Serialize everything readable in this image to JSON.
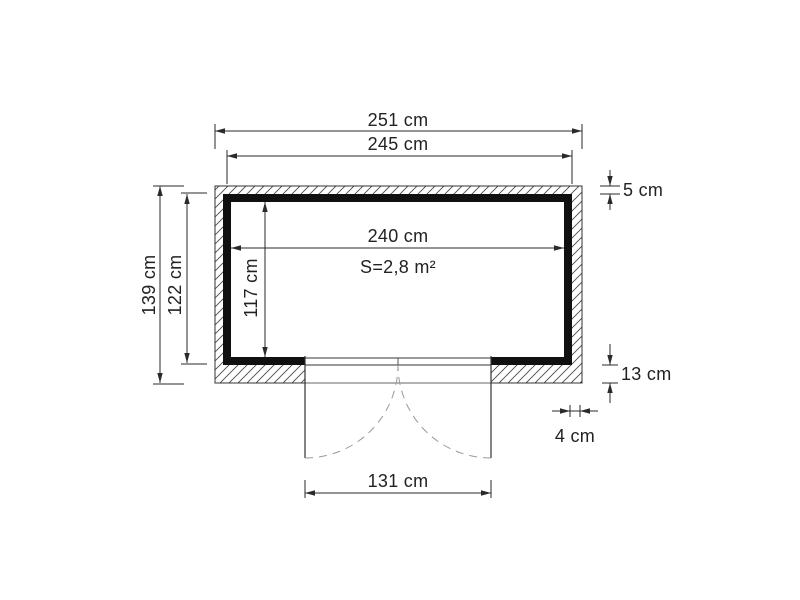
{
  "drawing": {
    "labels": {
      "outer_width": "251 cm",
      "frame_width": "245 cm",
      "inner_width": "240 cm",
      "area": "S=2,8 m²",
      "outer_depth": "139 cm",
      "frame_depth": "122 cm",
      "inner_depth": "117 cm",
      "top_wall_thickness": "5 cm",
      "bottom_wall_thickness": "13 cm",
      "side_offset": "4 cm",
      "door_width": "131 cm"
    },
    "colors": {
      "dimension_line": "#2a2a2a",
      "wall_fill": "#101010",
      "outline": "#333333",
      "hatch": "#4a4a4a",
      "door_swing_dash": "#999999",
      "background": "#ffffff"
    }
  }
}
